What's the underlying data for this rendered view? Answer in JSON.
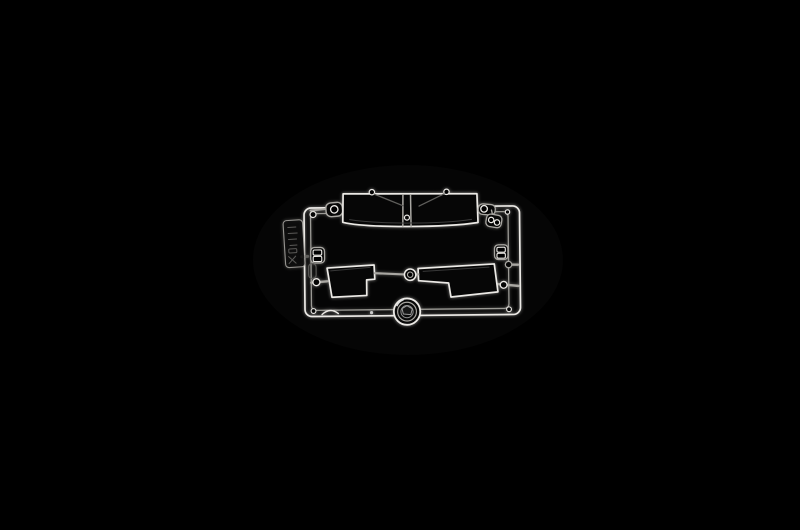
{
  "meta": {
    "description": "Product photograph of a clear transparent injection-molded model-kit sprue (parts tree) centered on a pure black background",
    "background": "photographic black, no visible text anywhere in the image"
  },
  "colors": {
    "background": "#000000",
    "edge-bright": "#eceae6",
    "edge-mid": "#a9a7a2",
    "edge-dim": "#5f5e5b",
    "glass-fill": "#060606"
  },
  "parts": [
    {
      "name": "sprue-frame",
      "desc": "rectangular clear runner frame with doubled bright rail edges"
    },
    {
      "name": "sprue-id-tag",
      "desc": "molded identification tab on left rail, faint embossed markings (illegible)"
    },
    {
      "name": "windshield-part",
      "desc": "wide two-pane windshield with center pillar and molded wiper details"
    },
    {
      "name": "side-window-left-part",
      "desc": "stepped door-window pane, notch at lower right"
    },
    {
      "name": "side-window-right-part",
      "desc": "mirrored stepped door-window pane, notch at lower left"
    },
    {
      "name": "grommet-ring-part",
      "desc": "small ring between the two door windows"
    },
    {
      "name": "headlight-lens-part",
      "desc": "round lens with concentric rings on bottom rail"
    },
    {
      "name": "lamp-bracket-part",
      "desc": "small paddle with round hole at top-left corner"
    },
    {
      "name": "lens-pair-top-right-part",
      "desc": "small piece with two round lenses near top-right corner"
    },
    {
      "name": "lens-pair-left-rail-part",
      "desc": "small piece with two square lenses on left rail"
    },
    {
      "name": "lens-pair-right-rail-part",
      "desc": "small piece with two square lenses on right rail"
    },
    {
      "name": "eyebrow-arc-part",
      "desc": "tiny curved sliver on bottom rail"
    }
  ]
}
